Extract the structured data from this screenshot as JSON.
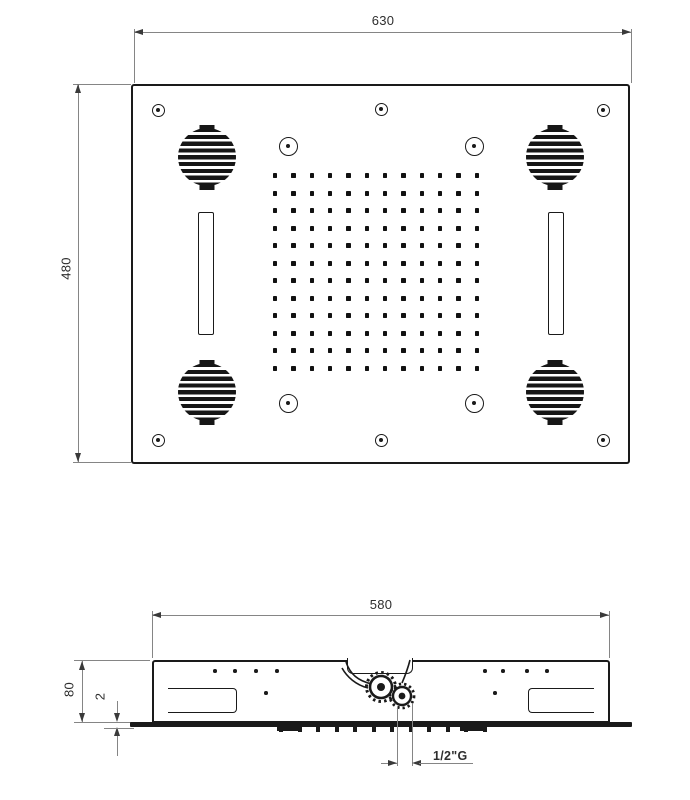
{
  "drawing": {
    "views": {
      "top": {
        "width_mm": "630",
        "height_mm": "480",
        "nozzle_grid": {
          "rows": 12,
          "cols": 12
        },
        "speaker_count": 4,
        "screw_hole_count": 6,
        "center_mark_count": 4,
        "light_slot_count": 2
      },
      "side": {
        "width_mm": "580",
        "height_mm": "80",
        "plate_thickness_mm": "2",
        "connection_thread": "1/2\"G",
        "nozzle_tick_count": 12
      }
    },
    "line_color": "#1a1a1a",
    "dimension_line_color": "#858585"
  }
}
